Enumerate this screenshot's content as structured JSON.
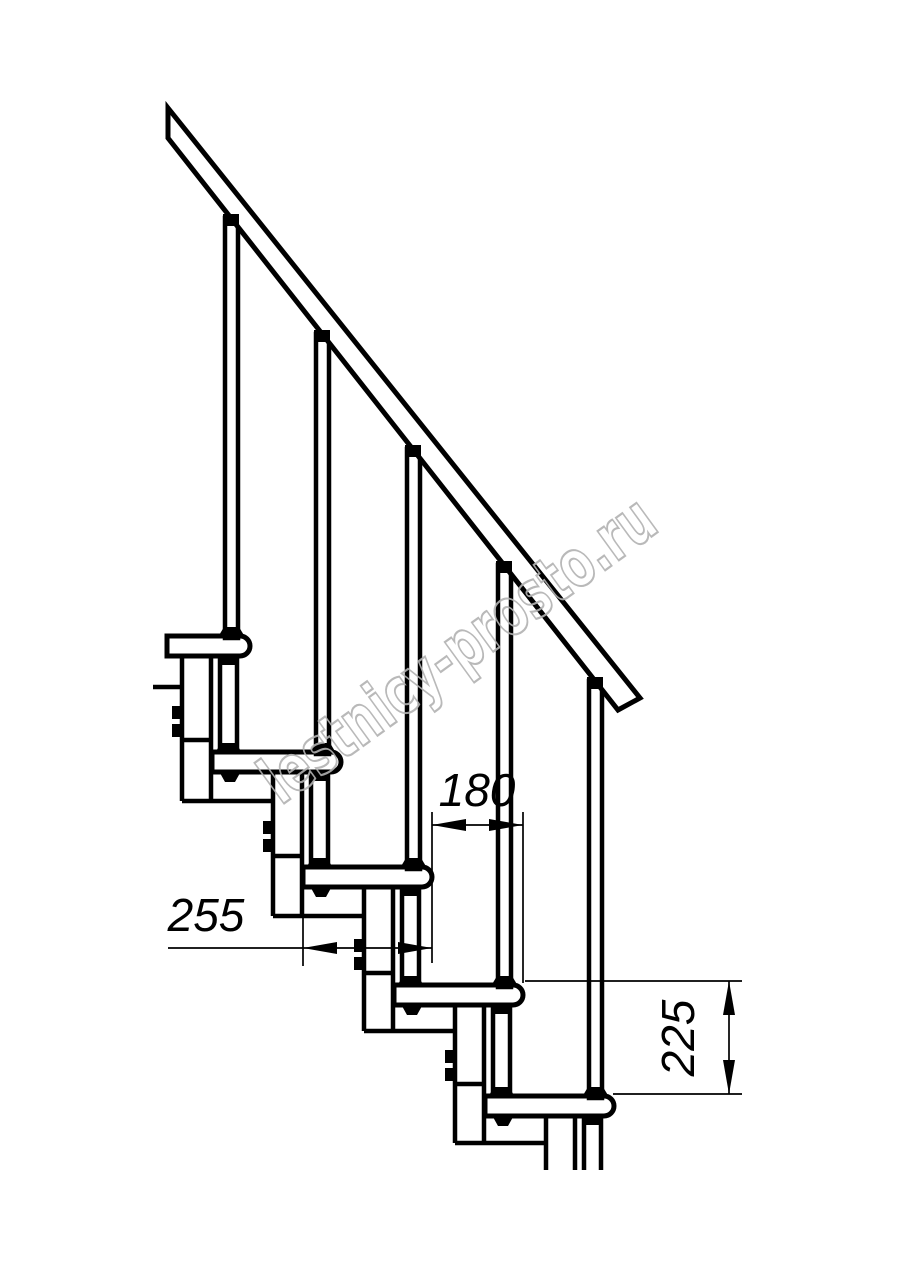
{
  "drawing": {
    "watermark": "lestnicy-prosto.ru",
    "dimensions": {
      "run": "180",
      "depth": "255",
      "rise": "225"
    },
    "colors": {
      "line": "#000000",
      "watermark": "#b2b2b2",
      "background": "#ffffff"
    }
  }
}
